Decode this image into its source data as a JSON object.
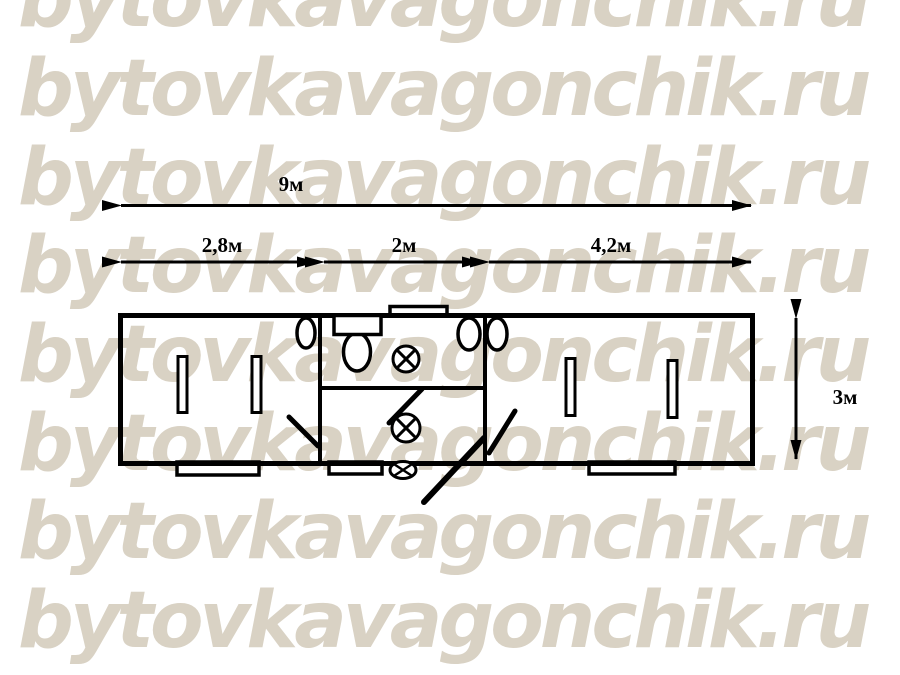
{
  "watermark": {
    "text": "bytovkavagonchik.ru",
    "color": "#d9d2c4",
    "rows": 8
  },
  "labels": {
    "total_length": "9м",
    "section_left": "2,8м",
    "section_middle": "2м",
    "section_right": "4,2м",
    "depth": "3м"
  },
  "colors": {
    "line": "#000000",
    "label": "#000000",
    "background": "#ffffff",
    "watermark": "#d9d2c4"
  },
  "diagram": {
    "type": "floor-plan",
    "subject": "portable cabin (bytovka) plan, 9m x 3m, three sections",
    "total_length_m": 9.0,
    "depth_m": 3.0,
    "sections": [
      {
        "name": "left-room",
        "length_m": 2.8,
        "symbols": [
          "window-slat",
          "window-slat",
          "wall-basin",
          "door-leaf",
          "entry-step"
        ]
      },
      {
        "name": "sanitary-block",
        "length_m": 2.0,
        "symbols": [
          "toilet",
          "basin",
          "ceiling-lamp",
          "ceiling-lamp",
          "entrance-lamp",
          "partition-wall",
          "door-leaf",
          "exterior-door-leaf",
          "entry-step",
          "roof-vent"
        ]
      },
      {
        "name": "right-room",
        "length_m": 4.2,
        "symbols": [
          "wall-basin",
          "window-slat",
          "window-slat",
          "door-leaf",
          "entry-step"
        ]
      }
    ]
  }
}
